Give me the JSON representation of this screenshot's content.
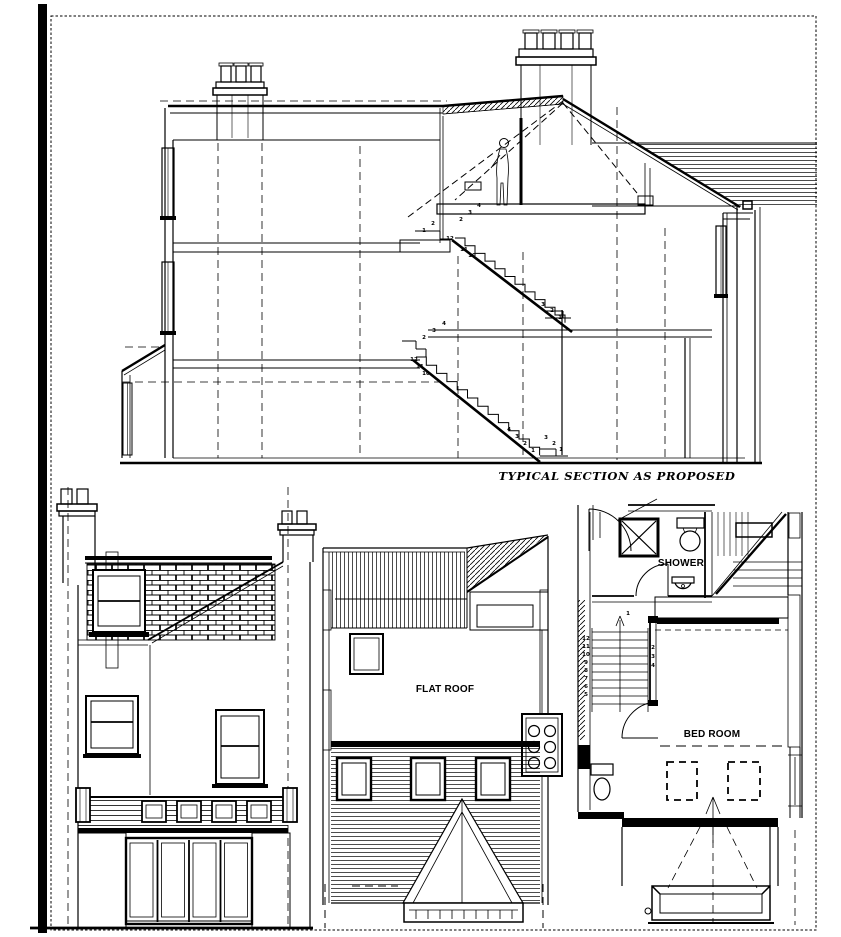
{
  "page": {
    "background": "#ffffff",
    "ink": "#000000"
  },
  "drawings": {
    "section": {
      "title": "TYPICAL SECTION AS PROPOSED",
      "upper_flight_numbers": [
        {
          "t": "1",
          "x": 424,
          "y": 232
        },
        {
          "t": "2",
          "x": 433,
          "y": 225
        },
        {
          "t": "12",
          "x": 450,
          "y": 240
        },
        {
          "t": "11",
          "x": 464,
          "y": 251
        },
        {
          "t": "10",
          "x": 472,
          "y": 257
        },
        {
          "t": "2",
          "x": 461,
          "y": 221
        },
        {
          "t": "3",
          "x": 470,
          "y": 214
        },
        {
          "t": "4",
          "x": 479,
          "y": 207
        },
        {
          "t": "3",
          "x": 543,
          "y": 306
        },
        {
          "t": "2",
          "x": 552,
          "y": 312
        },
        {
          "t": "1",
          "x": 560,
          "y": 319
        }
      ],
      "lower_flight_numbers": [
        {
          "t": "4",
          "x": 444,
          "y": 325
        },
        {
          "t": "3",
          "x": 434,
          "y": 332
        },
        {
          "t": "2",
          "x": 424,
          "y": 339
        },
        {
          "t": "12",
          "x": 414,
          "y": 361
        },
        {
          "t": "11",
          "x": 420,
          "y": 368
        },
        {
          "t": "10",
          "x": 426,
          "y": 375
        },
        {
          "t": "4",
          "x": 509,
          "y": 431
        },
        {
          "t": "3",
          "x": 517,
          "y": 438
        },
        {
          "t": "2",
          "x": 525,
          "y": 445
        },
        {
          "t": "1",
          "x": 533,
          "y": 452
        },
        {
          "t": "3",
          "x": 546,
          "y": 439
        },
        {
          "t": "2",
          "x": 554,
          "y": 445
        },
        {
          "t": "1",
          "x": 561,
          "y": 451
        }
      ]
    },
    "rear_elevation": {},
    "roof_plan": {
      "flat_roof_label": "FLAT ROOF"
    },
    "floor_plan": {
      "shower_label": "SHOWER",
      "bed_room_label": "BED ROOM",
      "stair_numbers": [
        {
          "t": "1",
          "x": 628,
          "y": 615
        },
        {
          "t": "12",
          "x": 586,
          "y": 640
        },
        {
          "t": "11",
          "x": 586,
          "y": 648
        },
        {
          "t": "10",
          "x": 586,
          "y": 656
        },
        {
          "t": "9",
          "x": 586,
          "y": 664
        },
        {
          "t": "8",
          "x": 586,
          "y": 672
        },
        {
          "t": "7",
          "x": 586,
          "y": 680
        },
        {
          "t": "6",
          "x": 586,
          "y": 688
        },
        {
          "t": "5",
          "x": 586,
          "y": 696
        },
        {
          "t": "2",
          "x": 653,
          "y": 649
        },
        {
          "t": "3",
          "x": 653,
          "y": 658
        },
        {
          "t": "4",
          "x": 653,
          "y": 667
        }
      ]
    }
  }
}
